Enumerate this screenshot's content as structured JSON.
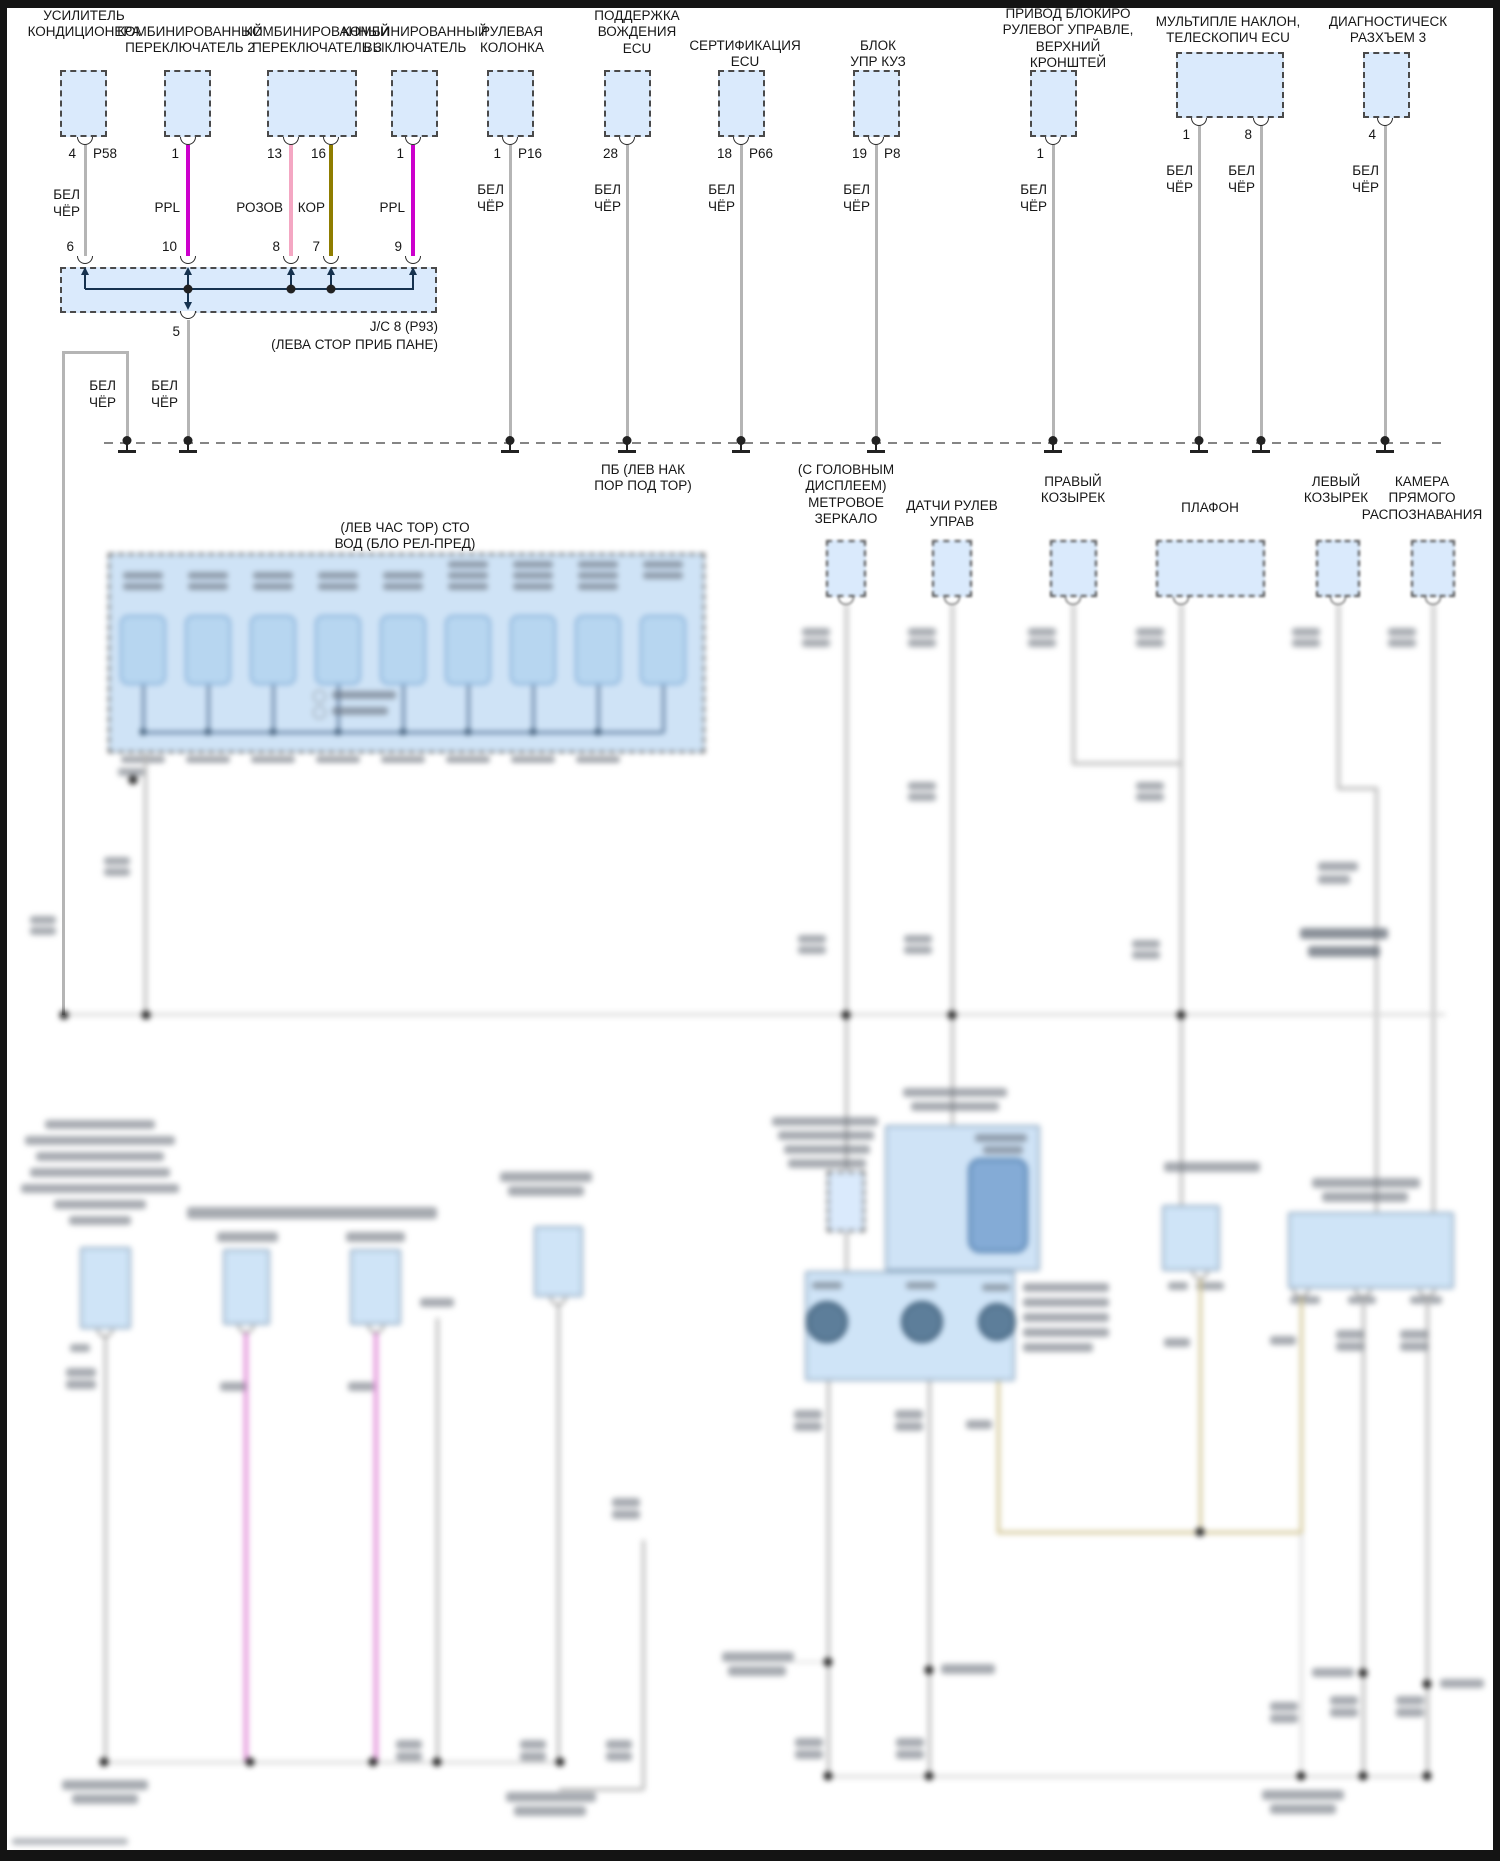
{
  "diagram": {
    "type": "automotive wiring diagram",
    "language": "Russian",
    "colors": {
      "connector_fill": "#daeafc",
      "wire_white_black": "#b5b5b5",
      "wire_ppl": "#cc00cc",
      "wire_pink": "#f4a7c3",
      "wire_brown": "#8f7d00",
      "wire_khaki": "#cfc28e",
      "ground_bus": "#858585"
    },
    "top_components": {
      "c1": {
        "label": "УСИЛИТЕЛЬ\nКОНДИЦИОНЕРА",
        "pin": "4",
        "conn": "P58",
        "wire": "БЕЛ\nЧЁР",
        "jpin": "6"
      },
      "c2": {
        "label": "КОМБИНИРОВАННЫЙ\nПЕРЕКЛЮЧАТЕЛЬ 2",
        "pin": "1",
        "wire": "PPL",
        "jpin": "10"
      },
      "c3": {
        "label": "КОМБИНИРОВАННЫЙ\nПЕРЕКЛЮЧАТЕЛЬ 3",
        "pin_a": "13",
        "pin_b": "16",
        "wire_a": "РОЗОВ",
        "wire_b": "КОР",
        "jpin_a": "8",
        "jpin_b": "7"
      },
      "c4": {
        "label": "КОМБИНИРОВАННЫЙ\nВЫКЛЮЧАТЕЛЬ",
        "pin": "1",
        "wire": "PPL",
        "jpin": "9"
      },
      "c5": {
        "label": "РУЛЕВАЯ\nКОЛОНКА",
        "pin": "1",
        "conn": "P16",
        "wire": "БЕЛ\nЧЁР"
      },
      "c6": {
        "label": "ПОДДЕРЖКА\nВОЖДЕНИЯ\nECU",
        "pin": "28",
        "wire": "БЕЛ\nЧЁР"
      },
      "c7": {
        "label": "СЕРТИФИКАЦИЯ\nECU",
        "pin": "18",
        "conn": "P66",
        "wire": "БЕЛ\nЧЁР"
      },
      "c8": {
        "label": "БЛОК\nУПР КУЗ",
        "pin": "19",
        "conn": "P8",
        "wire": "БЕЛ\nЧЁР"
      },
      "c9": {
        "label": "ПРИВОД БЛОКИРО\nРУЛЕВОГ УПРАВЛЕ,\nВЕРХНИЙ\nКРОНШТЕЙ",
        "pin": "1",
        "wire": "БЕЛ\nЧЁР"
      },
      "c10": {
        "label": "МУЛЬТИПЛЕ НАКЛОН,\nТЕЛЕСКОПИЧ ECU",
        "pin_a": "1",
        "pin_b": "8",
        "wire_a": "БЕЛ\nЧЁР",
        "wire_b": "БЕЛ\nЧЁР"
      },
      "c11": {
        "label": "ДИАГНОСТИЧЕСК\nРАЗХЪЕМ 3",
        "pin": "4",
        "wire": "БЕЛ\nЧЁР"
      }
    },
    "junction_block": {
      "label": "J/C 8 (P93)\n(ЛЕВА СТОР ПРИБ ПАНЕ)",
      "jpin6": "6",
      "jpin10": "10",
      "jpin8": "8",
      "jpin7": "7",
      "jpin9": "9",
      "bottom_pin": "5",
      "wire_left": "БЕЛ\nЧЁР",
      "wire_right": "БЕЛ\nЧЁР"
    },
    "ground_point_label": "ПБ (ЛЕВ НАК\nПОР ПОД ТОР)",
    "fuse_box_label": "(ЛЕВ ЧАС ТОР) СТО\nВОД (БЛО РЕЛ-ПРЕД)",
    "tier2_components": {
      "t1": {
        "label": "(С ГОЛОВНЫМ\nДИСПЛЕЕМ)\nМЕТРОВОЕ\nЗЕРКАЛО"
      },
      "t2": {
        "label": "ДАТЧИ РУЛЕВ\nУПРАВ"
      },
      "t3": {
        "label": "ПРАВЫЙ\nКОЗЫРЕК"
      },
      "t4": {
        "label": "ПЛАФОН"
      },
      "t5": {
        "label": "ЛЕВЫЙ\nКОЗЫРЕК"
      },
      "t6": {
        "label": "КАМЕРА ПРЯМОГО\nРАСПОЗНАВАНИЯ"
      }
    }
  }
}
